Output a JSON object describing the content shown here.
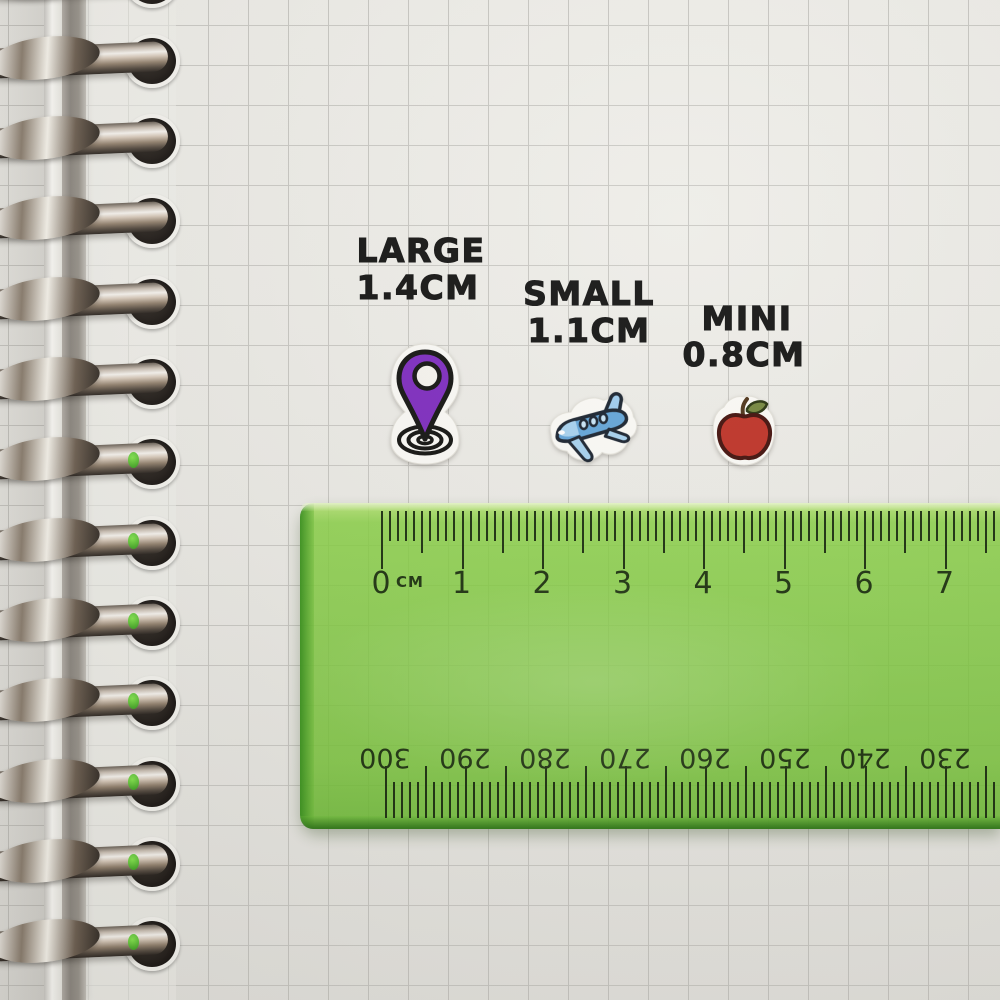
{
  "stickers": {
    "large": {
      "label": "LARGE",
      "size": "1.4CM",
      "icon": "location-pin-icon"
    },
    "small": {
      "label": "SMALL",
      "size": "1.1CM",
      "icon": "airplane-icon"
    },
    "mini": {
      "label": "MINI",
      "size": "0.8CM",
      "icon": "apple-icon"
    }
  },
  "ruler": {
    "unit_label": "CM",
    "top_numbers": [
      "0",
      "1",
      "2",
      "3",
      "4",
      "5",
      "6",
      "7"
    ],
    "bottom_numbers": [
      "300",
      "290",
      "280",
      "270",
      "260",
      "250",
      "240",
      "230"
    ],
    "body_color": "#84ce4f",
    "edge_color": "#3e9a28",
    "tick_color": "#1c300f"
  },
  "paper": {
    "color": "#ebeae5",
    "grid_color": "#c9c8c3"
  }
}
